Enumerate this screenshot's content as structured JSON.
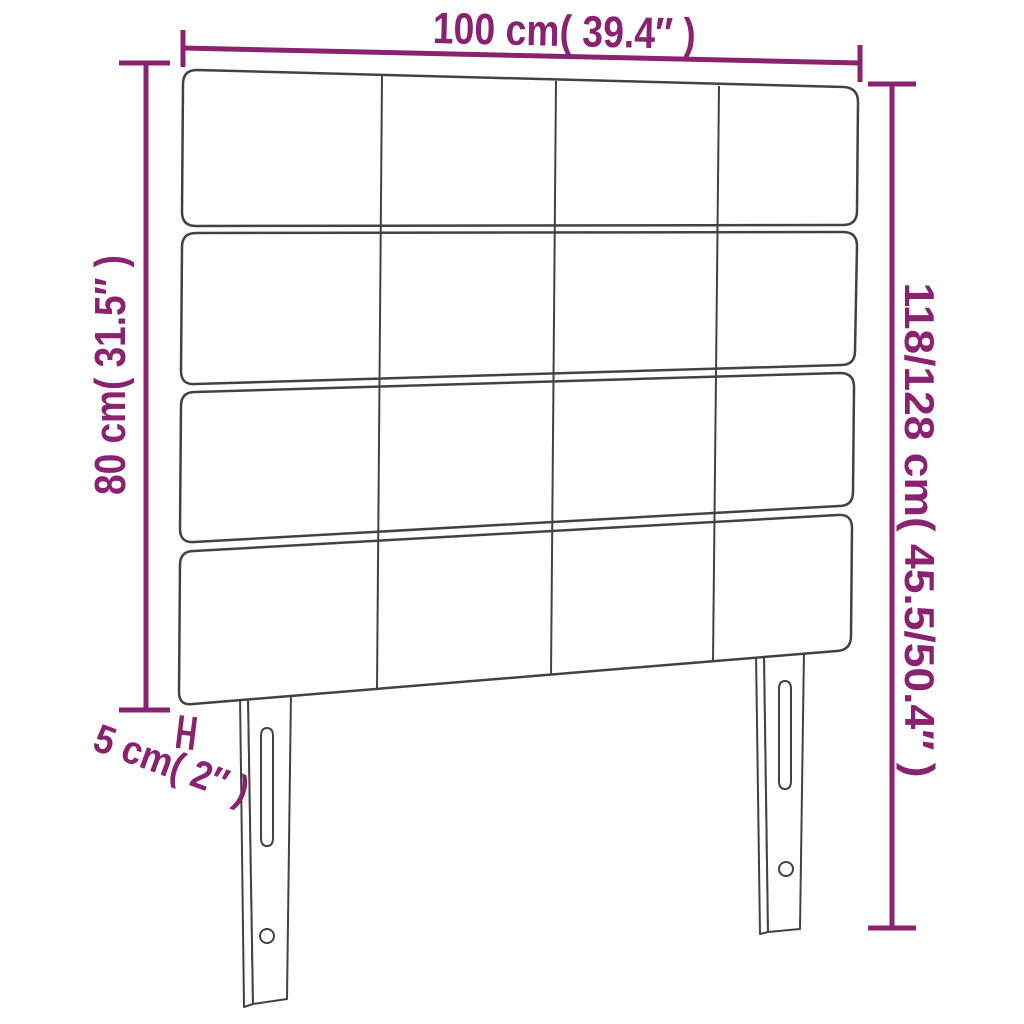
{
  "page": {
    "background": "#ffffff"
  },
  "colors": {
    "dimension_accent": "#892370",
    "line_art": "#424242",
    "panel_fill": "#ffffff"
  },
  "labels": {
    "width": "100 cm( 39.4″ )",
    "board_height": "80 cm( 31.5″ )",
    "total_height": "118/128 cm( 45.5/50.4″ )",
    "thickness": "5 cm( 2″ )"
  },
  "structure": {
    "subject": "upholstered headboard dimension diagram",
    "panel_rows": 4,
    "panel_columns": 4,
    "legs": 2
  }
}
